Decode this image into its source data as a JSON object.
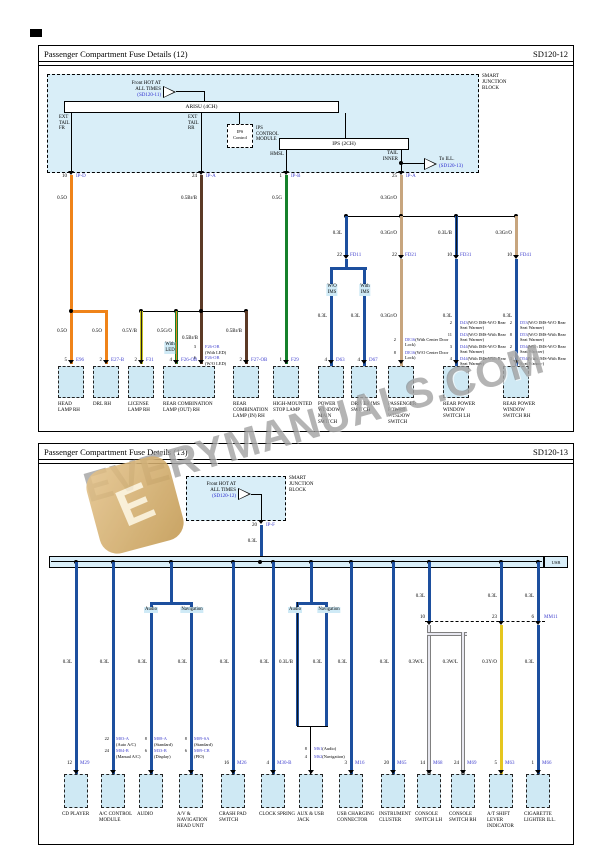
{
  "watermark": {
    "text": "EVERYMANUALS.COM",
    "logo_letter": "E"
  },
  "colors": {
    "connector_text": "#4343cf",
    "reference_link": "#2b2bd0",
    "block_fill": "#d9eef8",
    "component_fill": "#cfe9f4",
    "highlight_fill": "#cfeaf6",
    "wire_orange": "#ef8319",
    "wire_brown": "#5c3a26",
    "wire_green": "#15812b",
    "wire_tan": "#c7a57e",
    "wire_blue": "#1d4f9e",
    "wire_yellow": "#e5c61e",
    "wire_gray": "#e8e8f0"
  },
  "d12": {
    "title": "Passenger Compartment Fuse Details (12)",
    "code": "SD120-12",
    "sjb": {
      "l1": "SMART",
      "l2": "JUNCTION",
      "l3": "BLOCK",
      "feed_l1": "Front HOT AT",
      "feed_l2": "ALL TIMES",
      "feed_ref": "(SD120-11)",
      "arisu": "ARISU (4CH)",
      "ips2": "IPS (2CH)",
      "ips_box_l1": "IPS",
      "ips_box_l2": "Control",
      "ips_mod_l1": "IPS",
      "ips_mod_l2": "CONTROL",
      "ips_mod_l3": "MODULE",
      "ext_fr_l1": "EXT",
      "ext_fr_l2": "TAIL",
      "ext_fr_l3": "FR",
      "ext_rr_l1": "EXT",
      "ext_rr_l2": "TAIL",
      "ext_rr_l3": "RR",
      "hmsl": "HMSL",
      "tail_l1": "TAIL",
      "tail_l2": "INNER",
      "to_ill": "To ILL.",
      "to_ill_ref": "(SD120-13)"
    },
    "pins_top": [
      {
        "pin": "10",
        "conn": "IP-D"
      },
      {
        "pin": "24",
        "conn": "IP-A"
      },
      {
        "pin": "1",
        "conn": "IP-B"
      },
      {
        "pin": "25",
        "conn": "IP-A"
      }
    ],
    "fd": [
      {
        "pin": "22",
        "conn": "FD11"
      },
      {
        "pin": "22",
        "conn": "FD21"
      },
      {
        "pin": "10",
        "conn": "FD31"
      },
      {
        "pin": "10",
        "conn": "FD41"
      }
    ],
    "w": {
      "o1": "0.5O",
      "o2": "0.5O",
      "o3": "0.5O",
      "br1": "0.5Br/B",
      "br2": "0.5Br/B",
      "br3": "0.5Br/B",
      "yb": "0.5Y/B",
      "go": "0.5G/O",
      "g1": "0.5G",
      "t1": "0.3Gr/O",
      "r1t": "0.3L",
      "r2t": "0.3Gr/O",
      "r3t": "0.3L/B",
      "r4t": "0.3Gr/O",
      "r1a": "0.3L",
      "r1b": "0.3L",
      "r2b": "0.3Gr/O",
      "r3b": "0.3L",
      "r4b": "0.3L"
    },
    "hl": {
      "with_led_l1": "With",
      "with_led_l2": "LED",
      "wo_ims_l1": "W/O",
      "wo_ims_l2": "IMS",
      "with_ims_l1": "With",
      "with_ims_l2": "IMS"
    },
    "f26_opts": [
      {
        "pin": "3",
        "conn": "F26-OB",
        "note": "(With LED)"
      },
      {
        "pin": "6",
        "conn": "F26-OB",
        "note": "(W/O LED)"
      }
    ],
    "de16_opts": [
      {
        "pin": "2",
        "conn": "DE16",
        "note": "(With Center Door Lock)"
      },
      {
        "pin": "8",
        "conn": "DE16",
        "note": "(W/O Center Door Lock)"
      }
    ],
    "d4x_opts": [
      {
        "pin": "2",
        "conn": "D43",
        "note": "(W/O IMS-W/O Rear Seat Warmer)"
      },
      {
        "pin": "11",
        "conn": "D43",
        "note": "(W/O IMS-With Rear Seat Warmer)"
      },
      {
        "pin": "3",
        "conn": "D44",
        "note": "(With IMS-W/O Rear Seat Warmer)"
      },
      {
        "pin": "4",
        "conn": "D44",
        "note": "(With IMS-With Rear Seat Warmer)"
      }
    ],
    "d5x_opts": [
      {
        "pin": "2",
        "conn": "D53",
        "note": "(W/O IMS-W/O Rear Seat Warmer)"
      },
      {
        "pin": "8",
        "conn": "D53",
        "note": "(W/O IMS-With Rear Seat Warmer)"
      },
      {
        "pin": "2",
        "conn": "D54",
        "note": "(With IMS-W/O Rear Seat Warmer)"
      },
      {
        "pin": "3",
        "conn": "D54",
        "note": "(With IMS-With Rear Seat Warmer)"
      }
    ],
    "comp": [
      {
        "pin": "5",
        "conn": "E96",
        "name": "HEAD LAMP RH"
      },
      {
        "pin": "2",
        "conn": "E27-B",
        "name": "DRL RH"
      },
      {
        "pin": "2",
        "conn": "F31",
        "name": "LICENSE LAMP RH"
      },
      {
        "pin": "4",
        "conn": "F26-OB",
        "name": "REAR COMBINATION LAMP (OUT) RH"
      },
      {
        "pin": "2",
        "conn": "F27-OB",
        "name": "REAR COMBINATION LAMP (IN) RH"
      },
      {
        "pin": "1",
        "conn": "F29",
        "name": "HIGH-MOUNTED STOP LAMP"
      },
      {
        "pin": "4",
        "conn": "D63",
        "name": "POWER WINDOW MAIN SWITCH"
      },
      {
        "pin": "4",
        "conn": "D67",
        "name": "DRIVER IMS SWITCH"
      },
      {
        "name": "PASSENGER POWER WINDOW SWITCH"
      },
      {
        "name": "REAR POWER WINDOW SWITCH LH"
      },
      {
        "name": "REAR POWER WINDOW SWITCH RH"
      }
    ]
  },
  "d13": {
    "title": "Passenger Compartment Fuse Details (13)",
    "code": "SD120-13",
    "sjb": {
      "l1": "SMART",
      "l2": "JUNCTION",
      "l3": "BLOCK",
      "feed_l1": "Front HOT AT",
      "feed_l2": "ALL TIMES",
      "feed_ref": "(SD120-12)"
    },
    "pin_top": {
      "pin": "20",
      "conn": "IP-F"
    },
    "bus_end": "USB",
    "mm11": {
      "name": "MM11",
      "p1": "10",
      "p2": "23",
      "p3": "6"
    },
    "hl": {
      "audio": "Audio",
      "navigation": "Navigation"
    },
    "w": {
      "feed": "0.3L",
      "c1": "0.3L",
      "c2": "0.3L",
      "c3": "0.3L",
      "c4": "0.3L",
      "c5": "0.3L",
      "c6": "0.3L",
      "c7a": "0.3L/B",
      "c7b": "0.3L",
      "c8": "0.3L",
      "c9": "0.3L",
      "c10t": "0.3L",
      "c11t": "0.3L",
      "c12t": "0.3L",
      "c10a": "0.3W/L",
      "c10b": "0.3W/L",
      "c11b": "0.3Y/O",
      "c12b": "0.3L"
    },
    "comp": [
      {
        "name": "CD PLAYER",
        "o1p": "12",
        "o1c": "M29"
      },
      {
        "name": "A/C CONTROL MODULE",
        "o1p": "22",
        "o1c": "M03-A",
        "o1n": "(Auto A/C)",
        "o2p": "24",
        "o2c": "M04-B",
        "o2n": "(Manual A/C)"
      },
      {
        "name": "AUDIO",
        "o1p": "8",
        "o1c": "M08-A",
        "o1n": "(Standard)",
        "o2p": "6",
        "o2c": "M33-B",
        "o2n": "(Display)"
      },
      {
        "name": "A/V & NAVIGATION HEAD UNIT",
        "o1p": "8",
        "o1c": "M09-SA",
        "o1n": "(Standard)",
        "o2p": "6",
        "o2c": "M09-CB",
        "o2n": "(PIO)"
      },
      {
        "name": "CRASH PAD SWITCH",
        "o1p": "16",
        "o1c": "M26"
      },
      {
        "name": "CLOCK SPRING",
        "o1p": "4",
        "o1c": "M30-B"
      },
      {
        "name": "AUX & USB JACK",
        "o1p": "8",
        "o1c": "M61",
        "o1n": "(Audio)",
        "o2p": "4",
        "o2c": "M62",
        "o2n": "(Navigation)"
      },
      {
        "name": "USB CHARGING CONNECTOR",
        "o1p": "3",
        "o1c": "M16"
      },
      {
        "name": "INSTRUMENT CLUSTER",
        "o1p": "20",
        "o1c": "M65"
      },
      {
        "name": "CONSOLE SWITCH LH",
        "o1p": "14",
        "o1c": "M68"
      },
      {
        "name": "CONSOLE SWITCH RH",
        "o1p": "24",
        "o1c": "M69"
      },
      {
        "name": "A/T SHIFT LEVER INDICATOR",
        "o1p": "5",
        "o1c": "M63"
      },
      {
        "name": "CIGARETTE LIGHTER ILL.",
        "o1p": "1",
        "o1c": "M66"
      }
    ]
  }
}
